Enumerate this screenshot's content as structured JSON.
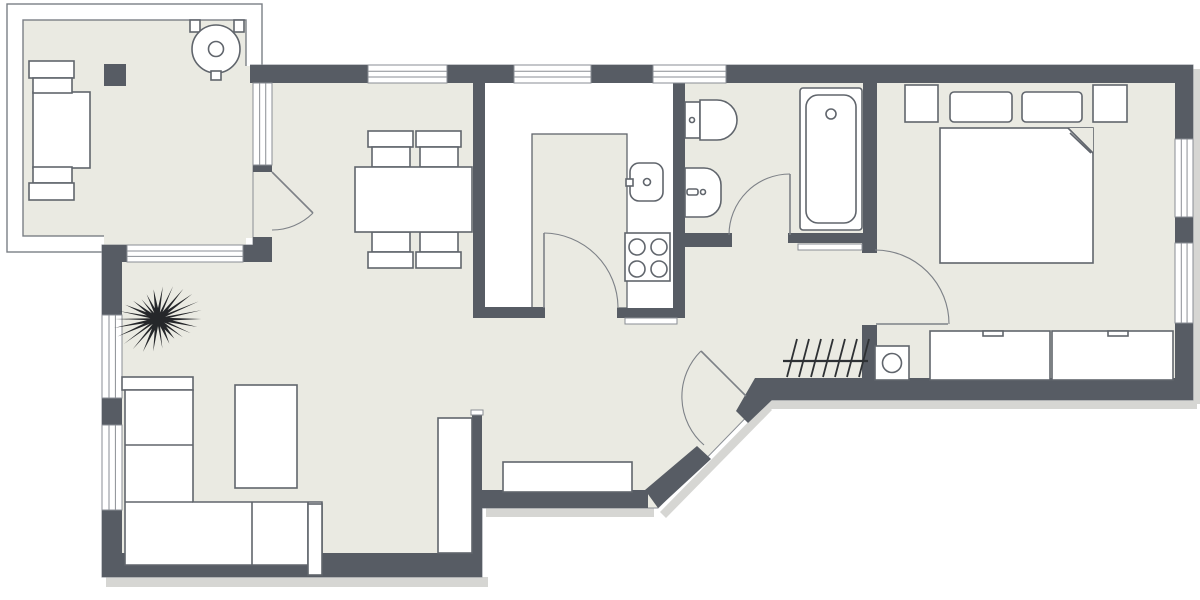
{
  "canvas": {
    "width": 1200,
    "height": 600
  },
  "colors": {
    "wall": "#575c64",
    "floor": "#eaeae2",
    "outside": "#ffffff",
    "outline": "#60656c",
    "glazing": "#8a8e94",
    "door": "#7d8187",
    "plant": "#25272a",
    "shadow": "#d6d6d3",
    "railing": "#7a7f85",
    "white": "#ffffff"
  },
  "floor_polygon": [
    [
      250,
      65
    ],
    [
      1193,
      65
    ],
    [
      1193,
      400
    ],
    [
      763,
      400
    ],
    [
      658,
      508
    ],
    [
      482,
      508
    ],
    [
      482,
      577
    ],
    [
      102,
      577
    ],
    [
      102,
      245
    ],
    [
      253,
      245
    ],
    [
      253,
      65
    ]
  ],
  "balcony": {
    "outer": [
      7,
      4,
      255,
      248
    ],
    "inner": [
      23,
      20,
      223,
      216
    ],
    "patches": [
      [
        240,
        66,
        13,
        172
      ],
      [
        104,
        235,
        142,
        10
      ]
    ]
  },
  "kitchen": {
    "counter": [
      485,
      83,
      188,
      235
    ],
    "island": [
      532,
      134,
      95,
      174
    ],
    "doorway": [
      545,
      307,
      72,
      13
    ]
  },
  "shadows": [
    {
      "name": "shadow-living-bottom",
      "t": "rect",
      "r": [
        106,
        577,
        382,
        10
      ]
    },
    {
      "name": "shadow-hall-bottom",
      "t": "rect",
      "r": [
        486,
        508,
        168,
        9
      ]
    },
    {
      "name": "shadow-bedroom-bottom",
      "t": "rect",
      "r": [
        760,
        400,
        437,
        9
      ]
    },
    {
      "name": "shadow-right-wall",
      "t": "rect",
      "r": [
        1193,
        69,
        7,
        335
      ]
    },
    {
      "name": "shadow-diagonal",
      "t": "poly",
      "pts": [
        [
          660,
          512
        ],
        [
          766,
          404
        ],
        [
          772,
          410
        ],
        [
          666,
          518
        ]
      ]
    }
  ],
  "walls": [
    {
      "name": "wall-top-living",
      "r": [
        250,
        65,
        118,
        18
      ]
    },
    {
      "name": "wall-top-pier-1",
      "r": [
        447,
        65,
        67,
        18
      ]
    },
    {
      "name": "wall-top-pier-2",
      "r": [
        591,
        65,
        62,
        18
      ]
    },
    {
      "name": "wall-top-right",
      "r": [
        726,
        65,
        467,
        18
      ]
    },
    {
      "name": "wall-right-upper",
      "r": [
        1175,
        83,
        18,
        56
      ]
    },
    {
      "name": "wall-right-mid",
      "r": [
        1175,
        217,
        18,
        26
      ]
    },
    {
      "name": "wall-right-lower",
      "r": [
        1175,
        323,
        18,
        77
      ]
    },
    {
      "name": "wall-bottom-bedroom",
      "r": [
        755,
        378,
        438,
        22
      ]
    },
    {
      "name": "wall-bedroom-hall-upper",
      "r": [
        862,
        233,
        15,
        20
      ]
    },
    {
      "name": "wall-bedroom-hall-lower",
      "r": [
        862,
        325,
        15,
        53
      ]
    },
    {
      "name": "wall-bath-bedroom",
      "r": [
        863,
        83,
        14,
        150
      ]
    },
    {
      "name": "wall-kitchen-bath",
      "r": [
        673,
        83,
        12,
        235
      ]
    },
    {
      "name": "wall-kitchen-living",
      "r": [
        473,
        83,
        12,
        234
      ]
    },
    {
      "name": "wall-kitchen-bottom-left",
      "r": [
        473,
        307,
        72,
        11
      ]
    },
    {
      "name": "wall-kitchen-bottom-right",
      "r": [
        617,
        308,
        68,
        10
      ]
    },
    {
      "name": "wall-bath-bottom-left",
      "r": [
        673,
        233,
        59,
        14
      ]
    },
    {
      "name": "wall-bath-bottom-right",
      "r": [
        788,
        233,
        77,
        10
      ]
    },
    {
      "name": "wall-living-hall",
      "r": [
        472,
        413,
        10,
        140
      ]
    },
    {
      "name": "wall-living-bottom",
      "r": [
        102,
        553,
        380,
        24
      ]
    },
    {
      "name": "wall-hall-bottom",
      "r": [
        482,
        490,
        166,
        18
      ]
    },
    {
      "name": "wall-left-upper",
      "r": [
        102,
        245,
        20,
        70
      ]
    },
    {
      "name": "wall-left-mid",
      "r": [
        102,
        398,
        20,
        27
      ]
    },
    {
      "name": "wall-left-lower",
      "r": [
        102,
        510,
        20,
        43
      ]
    },
    {
      "name": "wall-under-balcony-left",
      "r": [
        102,
        245,
        25,
        17
      ]
    },
    {
      "name": "wall-under-balcony-right",
      "r": [
        243,
        245,
        29,
        17
      ]
    },
    {
      "name": "wall-balcony-sill",
      "r": [
        253,
        165,
        19,
        7
      ]
    },
    {
      "name": "wall-balcony-pier",
      "r": [
        253,
        237,
        19,
        10
      ]
    }
  ],
  "diagonal_walls": [
    {
      "name": "wall-entry-diagonal-lower",
      "pts": [
        [
          645,
          490
        ],
        [
          697,
          446
        ],
        [
          711,
          459
        ],
        [
          658,
          508
        ]
      ]
    },
    {
      "name": "wall-entry-diagonal-upper",
      "pts": [
        [
          736,
          411
        ],
        [
          755,
          378
        ],
        [
          772,
          378
        ],
        [
          772,
          400
        ],
        [
          748,
          423
        ]
      ]
    }
  ],
  "windows": [
    {
      "name": "window-living-top",
      "r": [
        368,
        65,
        79,
        18
      ],
      "o": "h"
    },
    {
      "name": "window-kitchen-top",
      "r": [
        514,
        65,
        77,
        18
      ],
      "o": "h"
    },
    {
      "name": "window-bath-top",
      "r": [
        653,
        65,
        73,
        18
      ],
      "o": "h"
    },
    {
      "name": "window-bedroom-right-upper",
      "r": [
        1175,
        139,
        18,
        78
      ],
      "o": "v"
    },
    {
      "name": "window-bedroom-right-lower",
      "r": [
        1175,
        243,
        18,
        80
      ],
      "o": "v"
    },
    {
      "name": "window-living-left-upper",
      "r": [
        102,
        315,
        20,
        83
      ],
      "o": "v"
    },
    {
      "name": "window-living-left-lower",
      "r": [
        102,
        425,
        20,
        85
      ],
      "o": "v"
    },
    {
      "name": "window-under-balcony",
      "r": [
        127,
        245,
        116,
        17
      ],
      "o": "h"
    },
    {
      "name": "window-balcony-side",
      "r": [
        253,
        83,
        19,
        82
      ],
      "o": "v"
    }
  ],
  "thresholds": [
    {
      "name": "threshold-kitchen",
      "r": [
        625,
        318,
        52,
        6
      ]
    },
    {
      "name": "threshold-bath",
      "r": [
        798,
        244,
        64,
        6
      ]
    },
    {
      "name": "wall-cap-living-hall",
      "r": [
        471,
        410,
        12,
        5
      ]
    }
  ],
  "furniture": [
    {
      "name": "balcony-table",
      "shape": "rect",
      "r": [
        33,
        92,
        57,
        76
      ]
    },
    {
      "name": "balcony-chair-top-back",
      "shape": "rect",
      "r": [
        29,
        61,
        45,
        17
      ]
    },
    {
      "name": "balcony-chair-top-seat",
      "shape": "rect",
      "r": [
        33,
        78,
        39,
        15
      ]
    },
    {
      "name": "balcony-chair-bottom-seat",
      "shape": "rect",
      "r": [
        33,
        167,
        39,
        16
      ]
    },
    {
      "name": "balcony-chair-bottom-back",
      "shape": "rect",
      "r": [
        29,
        183,
        45,
        17
      ]
    },
    {
      "name": "balcony-storage-box",
      "shape": "rect",
      "r": [
        104,
        64,
        22,
        22
      ],
      "fill": "wall",
      "stroke": "none"
    },
    {
      "name": "grill-handle-left",
      "shape": "rect",
      "r": [
        190,
        20,
        10,
        12
      ]
    },
    {
      "name": "grill-handle-right",
      "shape": "rect",
      "r": [
        234,
        20,
        10,
        12
      ]
    },
    {
      "name": "grill-body",
      "shape": "circle",
      "c": [
        216,
        49
      ],
      "rad": 24
    },
    {
      "name": "grill-knob",
      "shape": "circle",
      "c": [
        216,
        49
      ],
      "rad": 7.5
    },
    {
      "name": "grill-tab",
      "shape": "rect",
      "r": [
        211,
        71,
        10,
        9
      ]
    },
    {
      "name": "dining-chair-1-back",
      "shape": "rect",
      "r": [
        368,
        131,
        45,
        16
      ]
    },
    {
      "name": "dining-chair-1-seat",
      "shape": "rect",
      "r": [
        372,
        147,
        38,
        20
      ]
    },
    {
      "name": "dining-chair-2-back",
      "shape": "rect",
      "r": [
        416,
        131,
        45,
        16
      ]
    },
    {
      "name": "dining-chair-2-seat",
      "shape": "rect",
      "r": [
        420,
        147,
        38,
        20
      ]
    },
    {
      "name": "dining-chair-3-seat",
      "shape": "rect",
      "r": [
        372,
        232,
        38,
        20
      ]
    },
    {
      "name": "dining-chair-3-back",
      "shape": "rect",
      "r": [
        368,
        252,
        45,
        16
      ]
    },
    {
      "name": "dining-chair-4-seat",
      "shape": "rect",
      "r": [
        420,
        232,
        38,
        20
      ]
    },
    {
      "name": "dining-chair-4-back",
      "shape": "rect",
      "r": [
        416,
        252,
        45,
        16
      ]
    },
    {
      "name": "dining-table",
      "shape": "rect",
      "r": [
        355,
        167,
        117,
        65
      ]
    },
    {
      "name": "sofa-headrest",
      "shape": "rect",
      "r": [
        122,
        377,
        71,
        13
      ]
    },
    {
      "name": "sofa-body",
      "shape": "polygon",
      "pts": [
        [
          125,
          390
        ],
        [
          193,
          390
        ],
        [
          193,
          502
        ],
        [
          322,
          502
        ],
        [
          322,
          565
        ],
        [
          125,
          565
        ]
      ]
    },
    {
      "name": "sofa-divider-1",
      "shape": "line",
      "p": [
        125,
        445,
        193,
        445
      ]
    },
    {
      "name": "sofa-divider-2",
      "shape": "line",
      "p": [
        125,
        502,
        193,
        502
      ]
    },
    {
      "name": "sofa-divider-3",
      "shape": "line",
      "p": [
        252,
        502,
        252,
        565
      ]
    },
    {
      "name": "sofa-divider-4",
      "shape": "line",
      "p": [
        308,
        502,
        308,
        565
      ]
    },
    {
      "name": "sofa-armrest",
      "shape": "rect",
      "r": [
        308,
        504,
        14,
        71
      ]
    },
    {
      "name": "coffee-table",
      "shape": "rect",
      "r": [
        235,
        385,
        62,
        103
      ]
    },
    {
      "name": "tv-sideboard",
      "shape": "rect",
      "r": [
        438,
        418,
        34,
        135
      ]
    },
    {
      "name": "hall-bench",
      "shape": "rect",
      "r": [
        503,
        462,
        129,
        30
      ]
    },
    {
      "name": "kitchen-sink",
      "shape": "rect",
      "r": [
        630,
        163,
        33,
        38
      ],
      "rx": 9
    },
    {
      "name": "kitchen-faucet",
      "shape": "rect",
      "r": [
        626,
        179,
        7,
        7
      ]
    },
    {
      "name": "kitchen-sink-drain",
      "shape": "circle",
      "c": [
        647,
        182
      ],
      "rad": 3.5
    },
    {
      "name": "stove",
      "shape": "rect",
      "r": [
        625,
        233,
        45,
        48
      ]
    },
    {
      "name": "stove-burner-1",
      "shape": "circle",
      "c": [
        637,
        247
      ],
      "rad": 8
    },
    {
      "name": "stove-burner-2",
      "shape": "circle",
      "c": [
        659,
        247
      ],
      "rad": 8
    },
    {
      "name": "stove-burner-3",
      "shape": "circle",
      "c": [
        637,
        269
      ],
      "rad": 8
    },
    {
      "name": "stove-burner-4",
      "shape": "circle",
      "c": [
        659,
        269
      ],
      "rad": 8
    },
    {
      "name": "toilet-tank",
      "shape": "rect",
      "r": [
        685,
        102,
        15,
        36
      ]
    },
    {
      "name": "toilet-bowl",
      "shape": "dpath",
      "d": "M700,100 h17 a20,20 0 0 1 0,40 h-17 z"
    },
    {
      "name": "toilet-button",
      "shape": "circle",
      "c": [
        692,
        120
      ],
      "rad": 2.5
    },
    {
      "name": "bathroom-sink",
      "shape": "dpath",
      "d": "M685,168 h19 a17,17 0 0 1 17,17 v15 a17,17 0 0 1 -17,17 h-19 z"
    },
    {
      "name": "bathroom-faucet",
      "shape": "rect",
      "r": [
        687,
        189,
        11,
        6
      ],
      "rx": 2
    },
    {
      "name": "bathroom-faucet-dot",
      "shape": "circle",
      "c": [
        703,
        192
      ],
      "rad": 2.5
    },
    {
      "name": "bathtub",
      "shape": "rect",
      "r": [
        800,
        88,
        62,
        142
      ],
      "rx": 3
    },
    {
      "name": "bathtub-inner",
      "shape": "rect",
      "r": [
        806,
        95,
        50,
        128
      ],
      "rx": 12
    },
    {
      "name": "bathtub-drain",
      "shape": "circle",
      "c": [
        831,
        114
      ],
      "rad": 5
    },
    {
      "name": "washing-machine",
      "shape": "rect",
      "r": [
        875,
        346,
        34,
        34
      ]
    },
    {
      "name": "washing-machine-door",
      "shape": "circle",
      "c": [
        892,
        363
      ],
      "rad": 9.5
    },
    {
      "name": "wardrobe-left",
      "shape": "rect",
      "r": [
        930,
        331,
        120,
        49
      ]
    },
    {
      "name": "wardrobe-left-handle",
      "shape": "rect",
      "r": [
        983,
        331,
        20,
        5
      ]
    },
    {
      "name": "wardrobe-right",
      "shape": "rect",
      "r": [
        1052,
        331,
        121,
        49
      ]
    },
    {
      "name": "wardrobe-right-handle",
      "shape": "rect",
      "r": [
        1108,
        331,
        20,
        5
      ]
    },
    {
      "name": "nightstand-left",
      "shape": "rect",
      "r": [
        905,
        85,
        33,
        37
      ]
    },
    {
      "name": "nightstand-right",
      "shape": "rect",
      "r": [
        1093,
        85,
        34,
        37
      ]
    },
    {
      "name": "double-bed",
      "shape": "rect",
      "r": [
        940,
        128,
        153,
        135
      ]
    },
    {
      "name": "pillow-left",
      "shape": "rect",
      "r": [
        950,
        92,
        62,
        30
      ],
      "rx": 4
    },
    {
      "name": "pillow-right",
      "shape": "rect",
      "r": [
        1022,
        92,
        60,
        30
      ],
      "rx": 4
    },
    {
      "name": "bed-fold-cut",
      "shape": "polygon",
      "pts": [
        [
          1068,
          128
        ],
        [
          1093,
          128
        ],
        [
          1093,
          153
        ]
      ],
      "fill": "floor",
      "stroke": "none"
    },
    {
      "name": "bed-fold-line",
      "shape": "line",
      "p": [
        1068,
        128,
        1093,
        153
      ]
    },
    {
      "name": "bed-fold-inner",
      "shape": "line",
      "p": [
        1070,
        133,
        1091,
        153
      ]
    }
  ],
  "radiator": {
    "name": "radiator",
    "line": [
      783,
      361,
      868,
      361
    ],
    "ticks": [
      [
        787,
        377,
        797,
        339
      ],
      [
        799,
        377,
        809,
        339
      ],
      [
        811,
        377,
        821,
        339
      ],
      [
        823,
        377,
        833,
        339
      ],
      [
        835,
        377,
        845,
        339
      ],
      [
        847,
        377,
        857,
        339
      ],
      [
        859,
        377,
        869,
        339
      ]
    ]
  },
  "plant": {
    "name": "potted-plant",
    "cx": 158,
    "cy": 319,
    "rx": 46,
    "ry": 38,
    "spikes": 26
  },
  "doors": [
    {
      "name": "balcony-door",
      "leaf": [
        272,
        172,
        313,
        213
      ],
      "arc": "M313,213 A58,58 0 0 1 272,230"
    },
    {
      "name": "kitchen-door",
      "leaf": [
        544,
        233,
        544,
        308
      ],
      "arc": "M544,233 A75,75 0 0 1 618,307"
    },
    {
      "name": "bathroom-door",
      "leaf": [
        790,
        174,
        790,
        235
      ],
      "arc": "M790,174 A61,61 0 0 0 729,235"
    },
    {
      "name": "bedroom-door",
      "leaf": [
        876,
        324,
        948,
        324
      ],
      "arc": "M875,250 A74,74 0 0 1 949,324"
    },
    {
      "name": "entry-door",
      "leaf": [
        746,
        396,
        701,
        351
      ],
      "arc": "M701,351 A64,64 0 0 0 704,445"
    }
  ]
}
